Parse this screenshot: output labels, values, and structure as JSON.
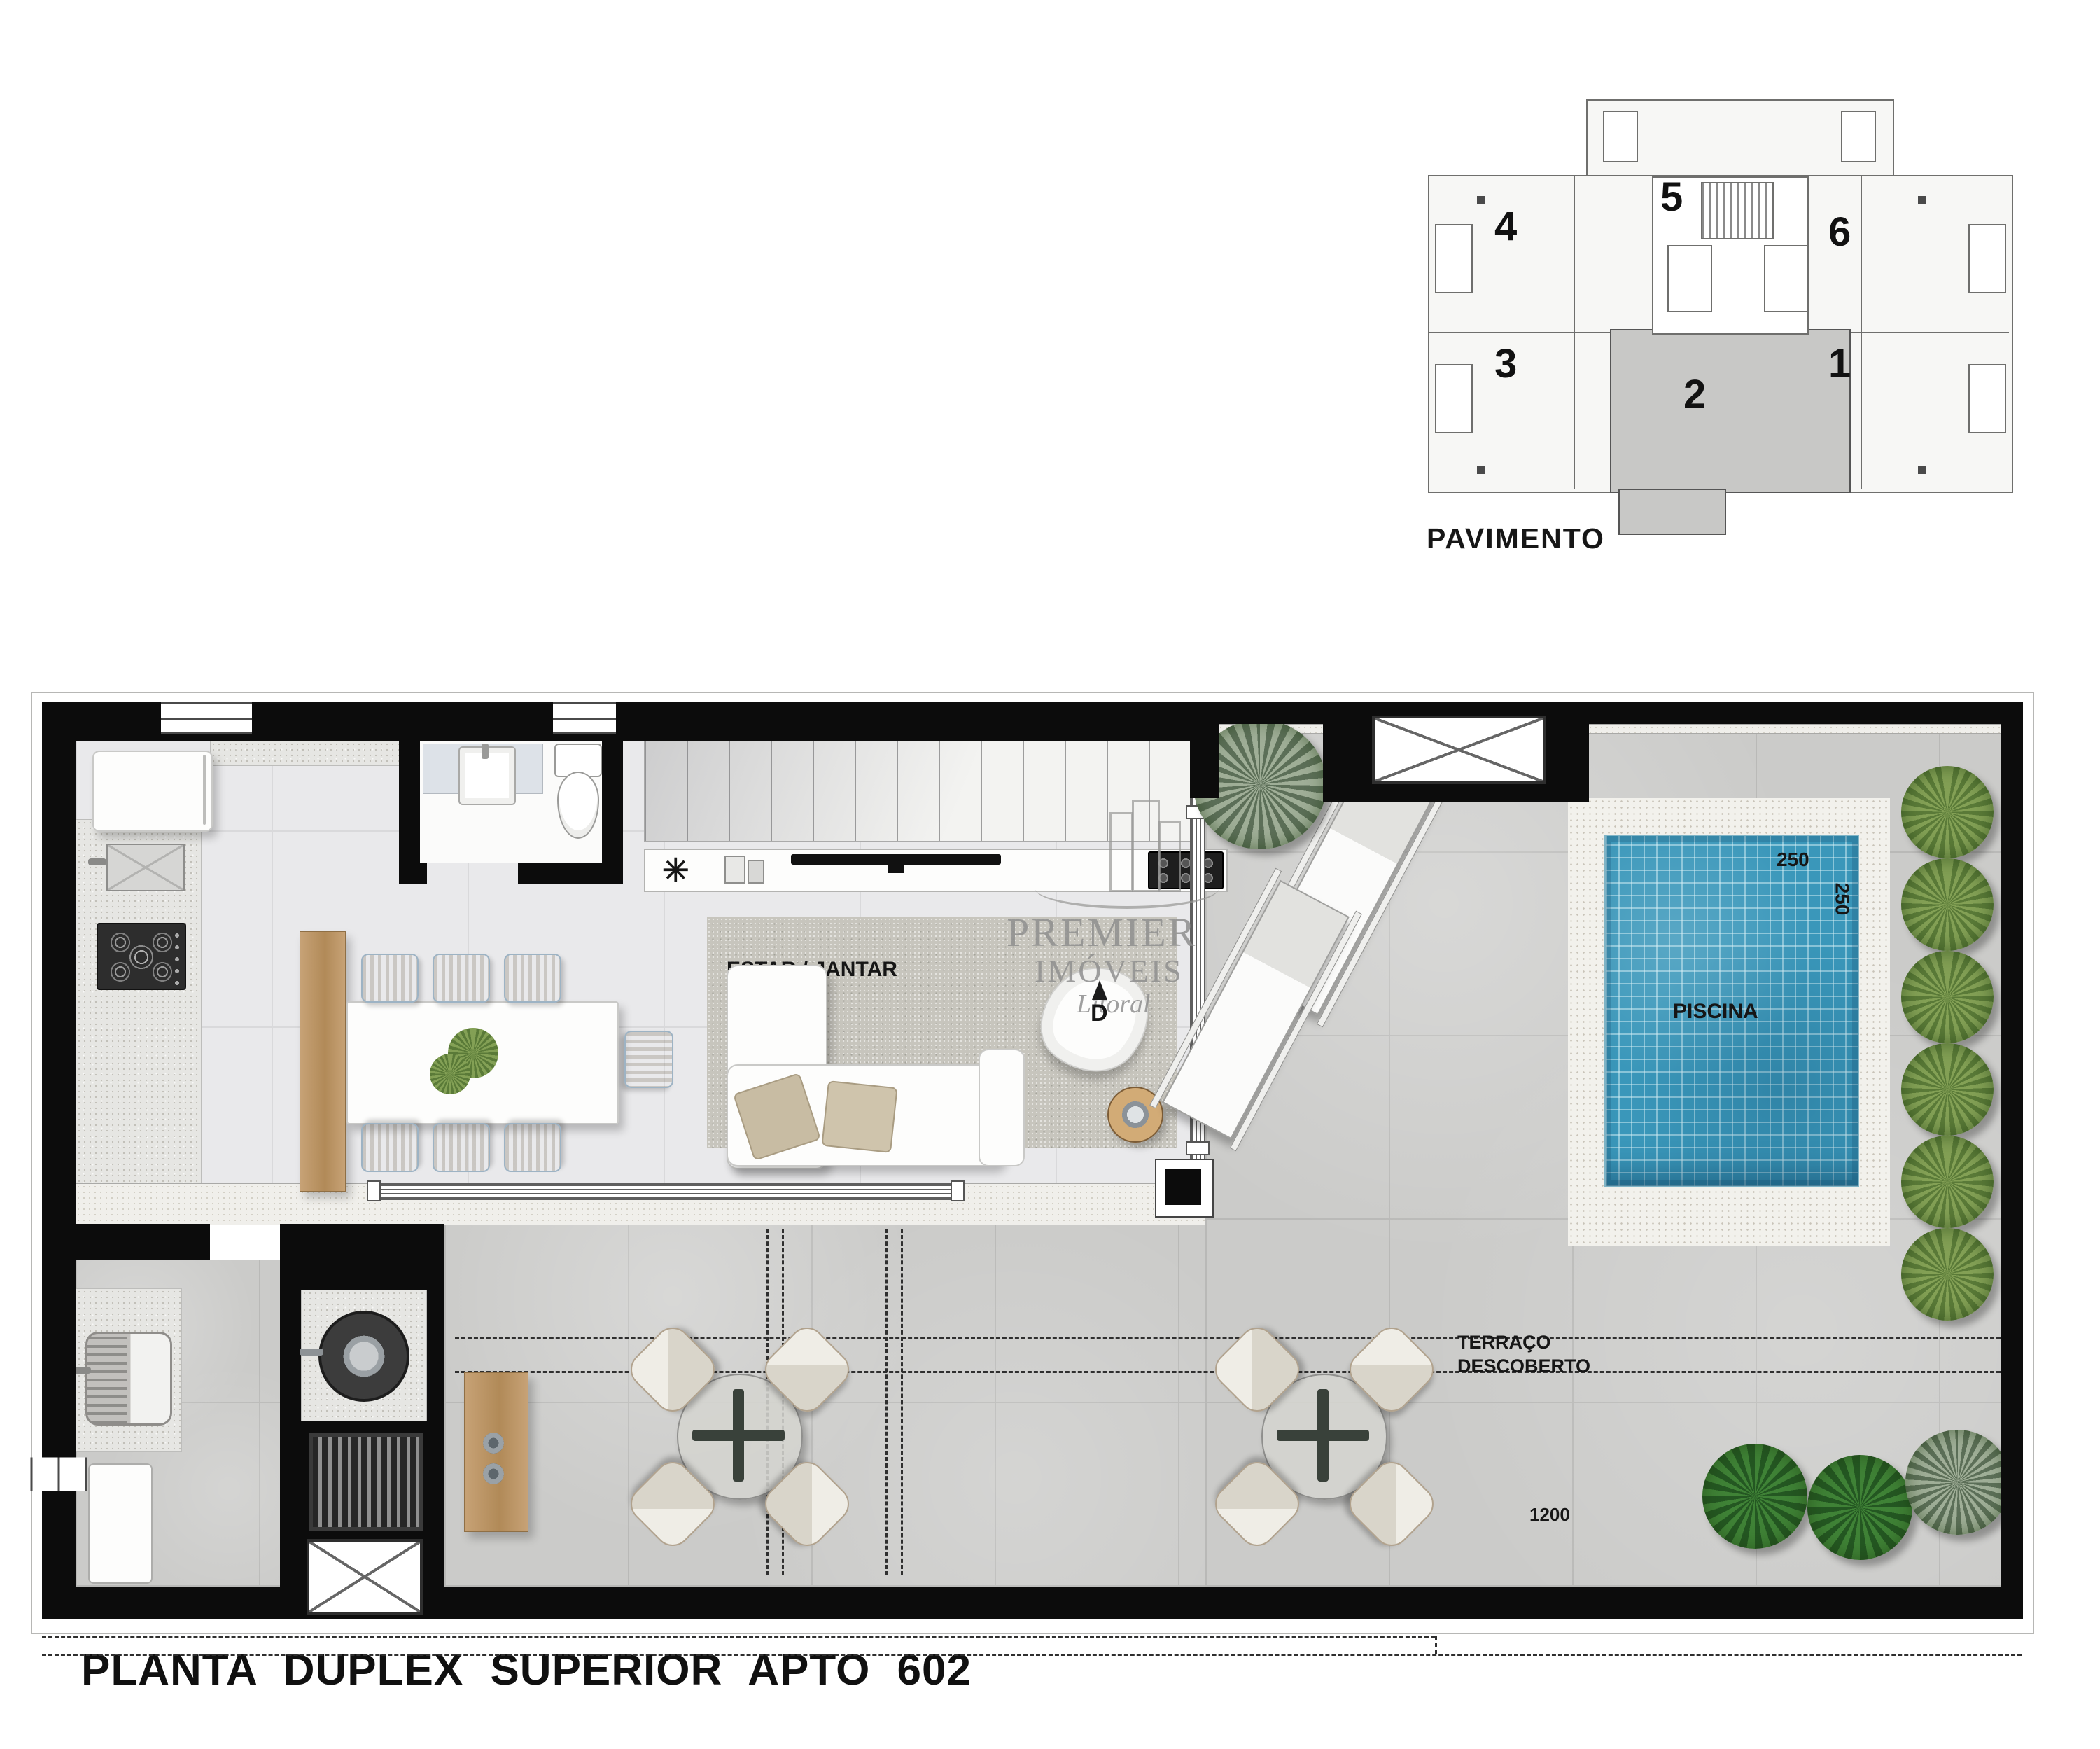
{
  "page": {
    "title": "PLANTA DUPLEX SUPERIOR APTO 602"
  },
  "key_plan": {
    "label": "PAVIMENTO",
    "units": {
      "u1": "1",
      "u2": "2",
      "u3": "3",
      "u4": "4",
      "u5": "5",
      "u6": "6"
    },
    "highlighted_unit": "2"
  },
  "rooms": {
    "lavabo": "LAVABO",
    "living": "ESTAR / JANTAR",
    "pool": "PISCINA",
    "terrace_line1": "TERRAÇO",
    "terrace_line2": "DESCOBERTO",
    "service": "Á. SERV."
  },
  "dimensions": {
    "d213": "213",
    "d105": "105",
    "d150_lavabo": "150",
    "d90": "90",
    "d410": "410",
    "d780": "780",
    "d250_w": "250",
    "d250_h": "250",
    "d609": "609",
    "d1200": "1200",
    "d177": "177",
    "d150_serv": "150"
  },
  "stairs": {
    "direction_marker": "D"
  },
  "watermark": {
    "line1": "PREMIER",
    "line2": "IMÓVEIS",
    "script": "Litoral"
  },
  "icons": {
    "star_decor": "✳"
  },
  "colors": {
    "wall": "#0c0c0c",
    "pool_water": "#3a97ba",
    "plan_green": "#5a7a38",
    "unit_highlight": "#c8c8c6"
  }
}
